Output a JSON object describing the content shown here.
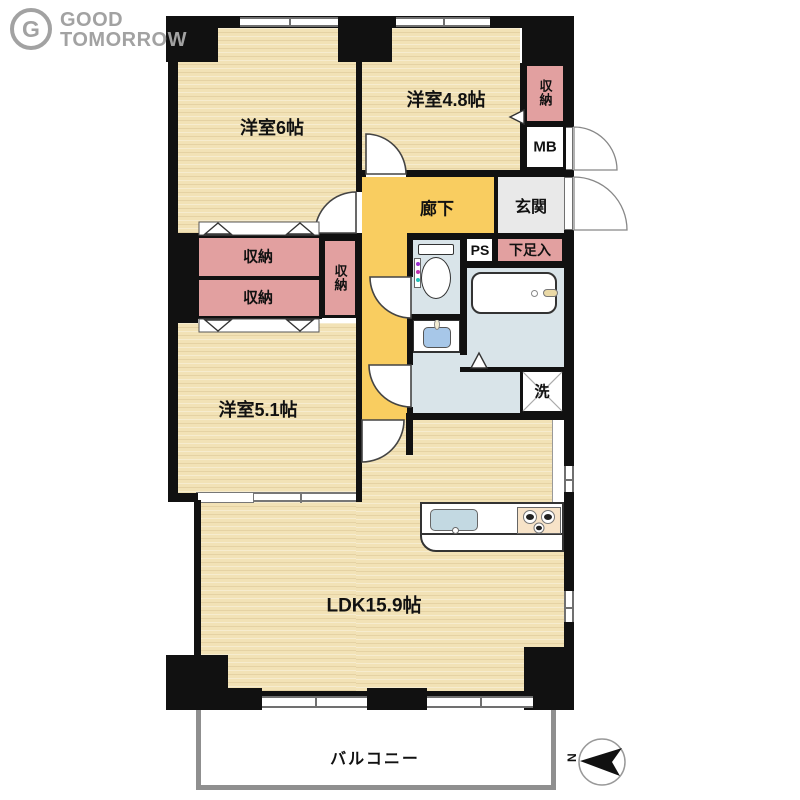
{
  "brand": {
    "icon_letter": "G",
    "line1": "GOOD",
    "line2": "TOMORROW"
  },
  "floorplan": {
    "rooms": {
      "bedroom_6": "洋室6帖",
      "bedroom_4_8": "洋室4.8帖",
      "bedroom_5_1": "洋室5.1帖",
      "ldk": "LDK15.9帖",
      "corridor": "廊下",
      "entrance_hall": "玄関",
      "balcony": "バルコニー"
    },
    "fixtures": {
      "storage": "収納",
      "shoe_cabinet": "下足入",
      "pipe_space": "PS",
      "meter_box": "MB",
      "laundry": "洗"
    },
    "compass": {
      "north": "N"
    }
  },
  "colors": {
    "wood": "#f2e2b6",
    "corridor": "#f9cd60",
    "closet": "#e2a0a0",
    "genkan": "#e9e9e9",
    "wet": "#d9e4e9",
    "wall": "#111111",
    "wf": "#707070",
    "sink": "#c3d9e2",
    "basin_sink": "#a7c7e8",
    "stove": "#f7e3c8",
    "balc": "#8f8f8f",
    "logo": "#a2a2a2",
    "arc": "#444444"
  }
}
